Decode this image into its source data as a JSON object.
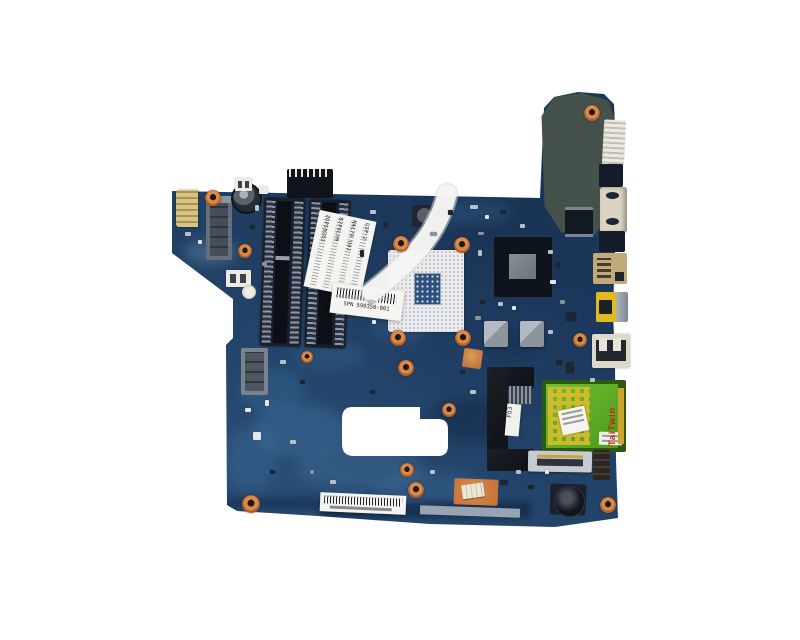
{
  "scene": {
    "type": "product-photo",
    "subject": "laptop motherboard, top view on white background"
  },
  "palette": {
    "background": "#ffffff",
    "pcb": "#1d3b60",
    "pcb_dark": "#16294a",
    "pcb_light": "#4577a6",
    "copper": "#c9763a",
    "cpu_socket": "#ebebee",
    "chipset": "#0e141c",
    "chipset_die": "#7b8187",
    "card_green": "#5aab24",
    "gold": "#caa42c",
    "hdmi_yellow": "#e3ba1d",
    "lan_tan": "#c0a97a",
    "vga_cream": "#dbd4c2",
    "label_white": "#f4f4f0",
    "brand_red": "#cf1d10",
    "corroded_region": "#44524b"
  },
  "labels": {
    "card_brand": "TaiTwin",
    "hdd_label": "F03",
    "sticker1_lines": [
      "2GPS9262",
      "B2P6LYN",
      "NAL70 U02",
      "L2P-2"
    ],
    "sticker2_caption": "SPN 590350-001"
  }
}
